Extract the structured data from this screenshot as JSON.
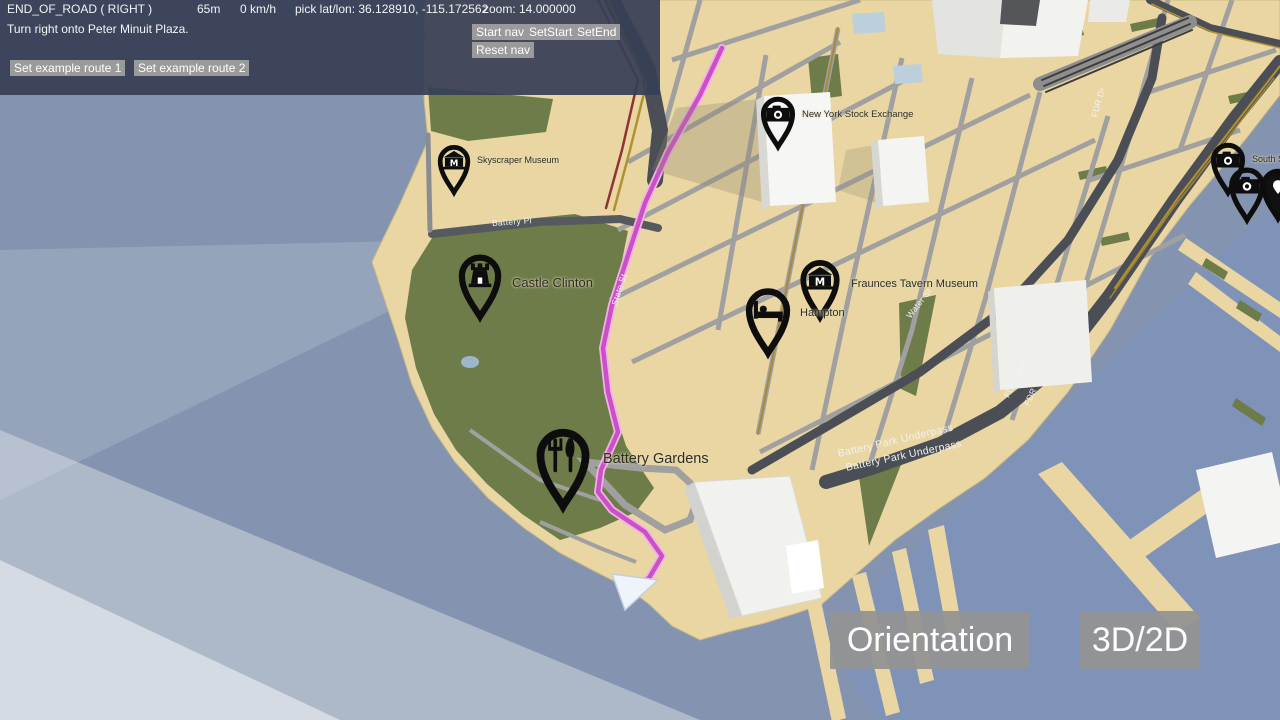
{
  "header": {
    "status": "END_OF_ROAD ( RIGHT )",
    "distance": "65m",
    "speed": "0 km/h",
    "pick": "pick lat/lon: 36.128910, -115.172562",
    "zoom": "zoom: 14.000000",
    "instruction": "Turn right onto Peter Minuit Plaza.",
    "buttons": {
      "start_nav": "Start nav",
      "set_start": "SetStart",
      "set_end": "SetEnd",
      "reset_nav": "Reset nav",
      "route1": "Set example route 1",
      "route2": "Set example route 2"
    }
  },
  "controls": {
    "orientation": "Orientation",
    "mode": "3D/2D"
  },
  "map": {
    "pois": [
      {
        "label": "Skyscraper Museum",
        "icon": "museum-icon"
      },
      {
        "label": "New York Stock Exchange",
        "icon": "camera-icon"
      },
      {
        "label": "Castle Clinton",
        "icon": "castle-icon"
      },
      {
        "label": "Fraunces Tavern Museum",
        "icon": "museum-icon"
      },
      {
        "label": "Hampton",
        "icon": "lodging-icon"
      },
      {
        "label": "Battery Gardens",
        "icon": "restaurant-icon"
      },
      {
        "label": "South S",
        "icon": "camera-icon"
      },
      {
        "label": "",
        "icon": "camera-icon"
      },
      {
        "label": "",
        "icon": "marker-icon"
      }
    ],
    "road_labels": [
      "Battery Pl",
      "State St",
      "Water St",
      "South St",
      "FDR Dr",
      "FDR Dr",
      "Battery Park Underpass",
      "Battery Park Underpass",
      "FDR Dr"
    ],
    "colors": {
      "water": "#8494b0",
      "land": "#e9d6a2",
      "park": "#6d7c49",
      "road_major": "#4b4f55",
      "road_minor": "#a0a0a0",
      "route": "#cc4fc6",
      "header_bg": "#373f55",
      "button_gray": "#9a9a9a"
    }
  }
}
